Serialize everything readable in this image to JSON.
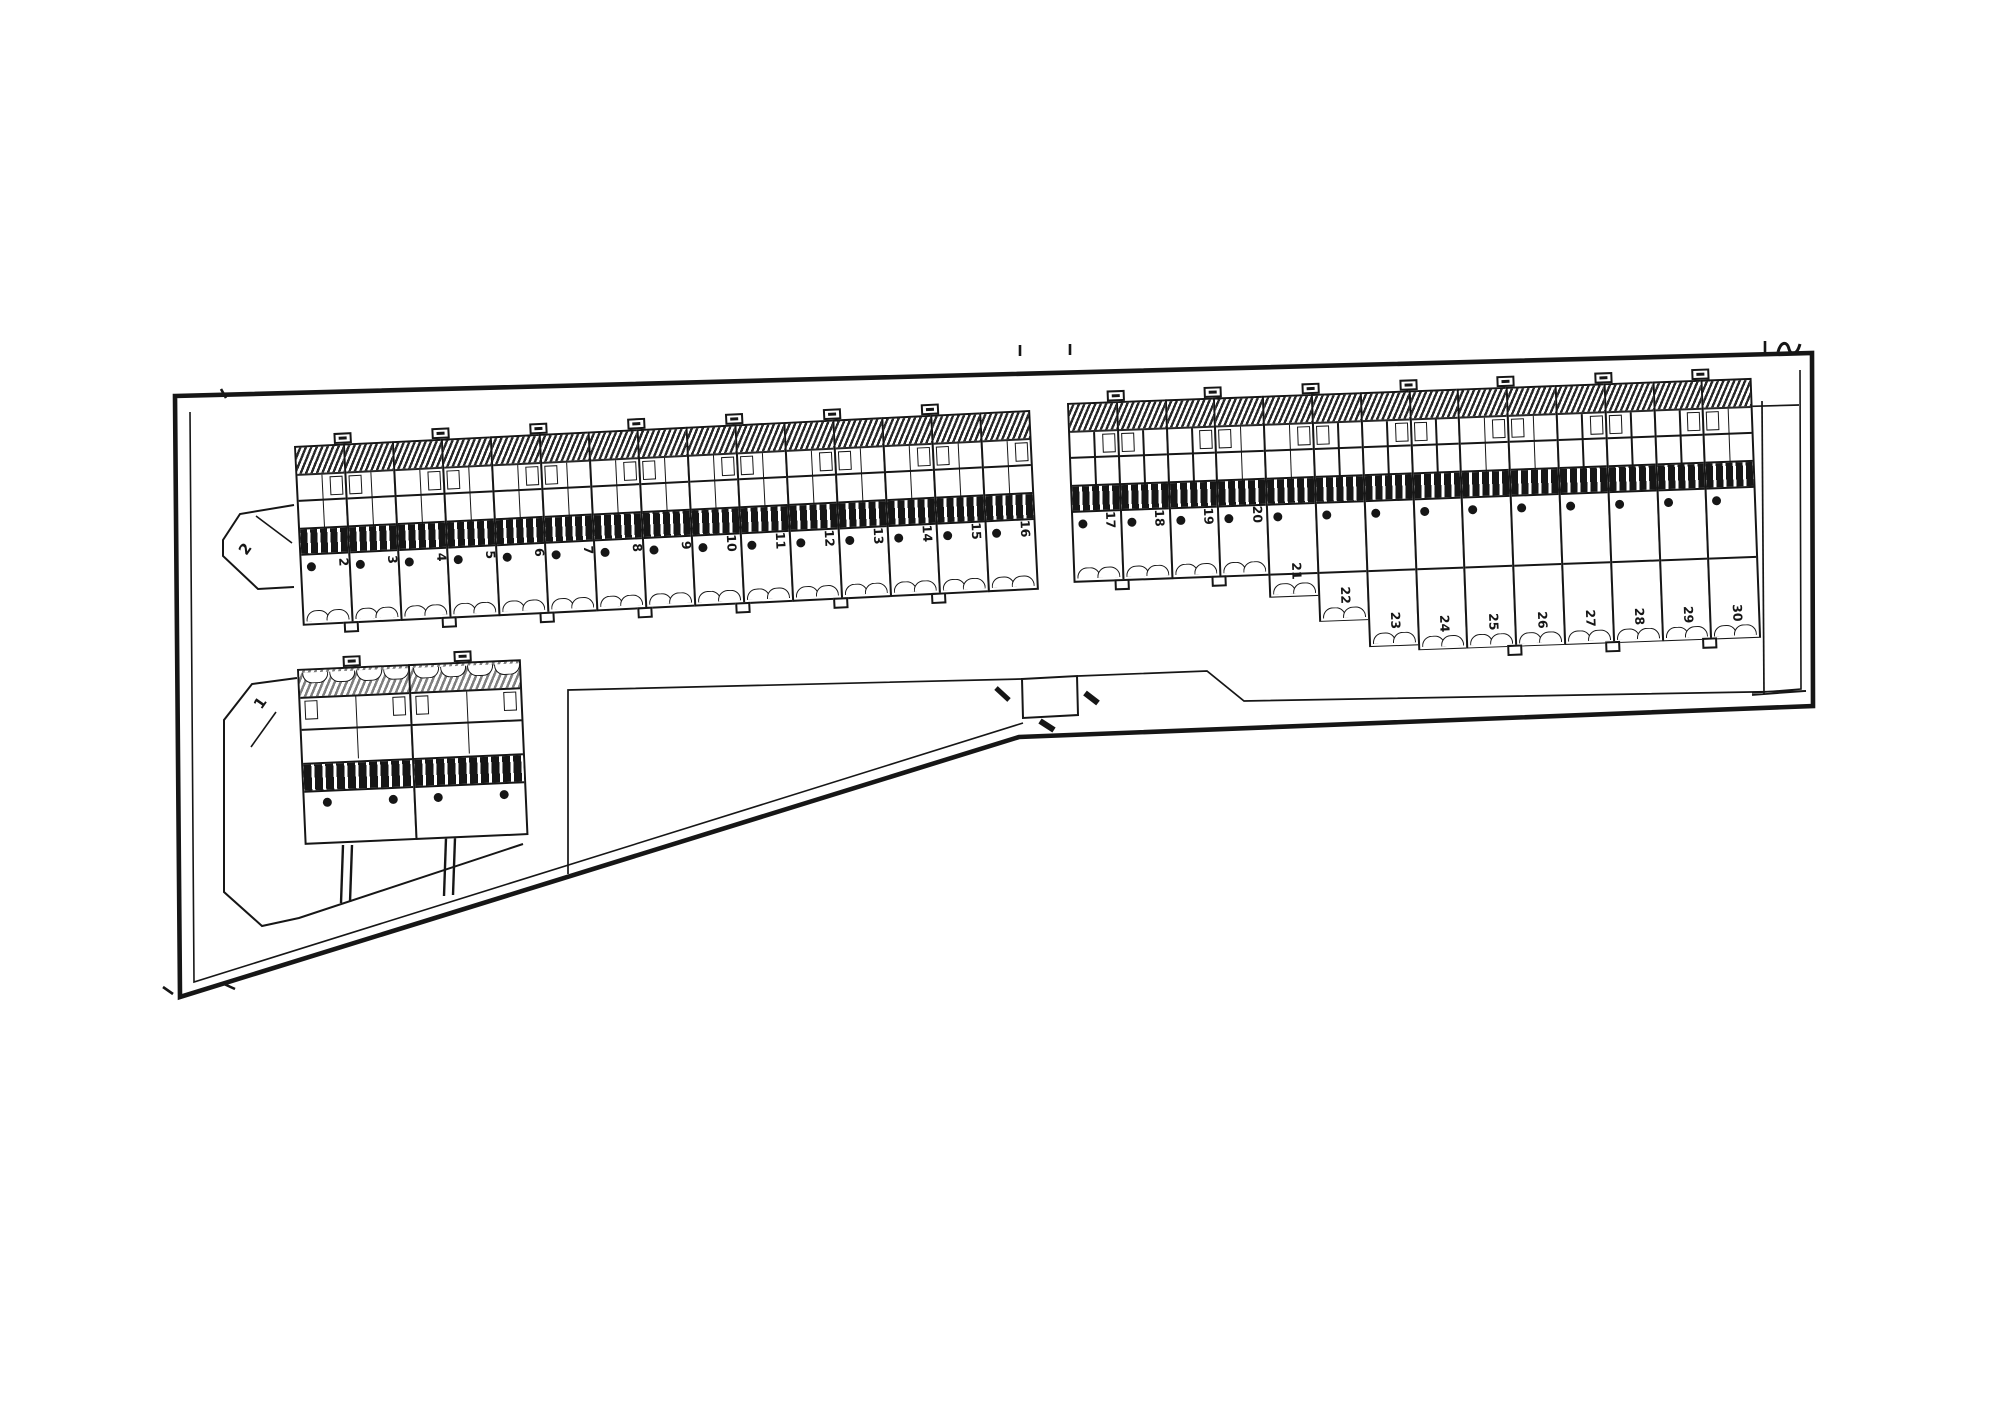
{
  "canvas": {
    "paper": "#ffffff",
    "ink": "#161616"
  },
  "lots": {
    "cluster": {
      "label": "1"
    },
    "row_a": {
      "end_label": "2",
      "unit_numbers": [
        "2",
        "3",
        "4",
        "5",
        "6",
        "7",
        "8",
        "9",
        "10",
        "11",
        "12",
        "13",
        "14",
        "15",
        "16"
      ]
    },
    "row_b": {
      "unit_numbers": [
        "17",
        "18",
        "19",
        "20",
        "21",
        "22",
        "23",
        "24",
        "25",
        "26",
        "27",
        "28",
        "29",
        "30"
      ]
    }
  },
  "marks": {
    "corner_mark": "squiggle-survey-mark",
    "boundary_tick": "tick-mark",
    "entrance_tick": "tick-mark"
  }
}
